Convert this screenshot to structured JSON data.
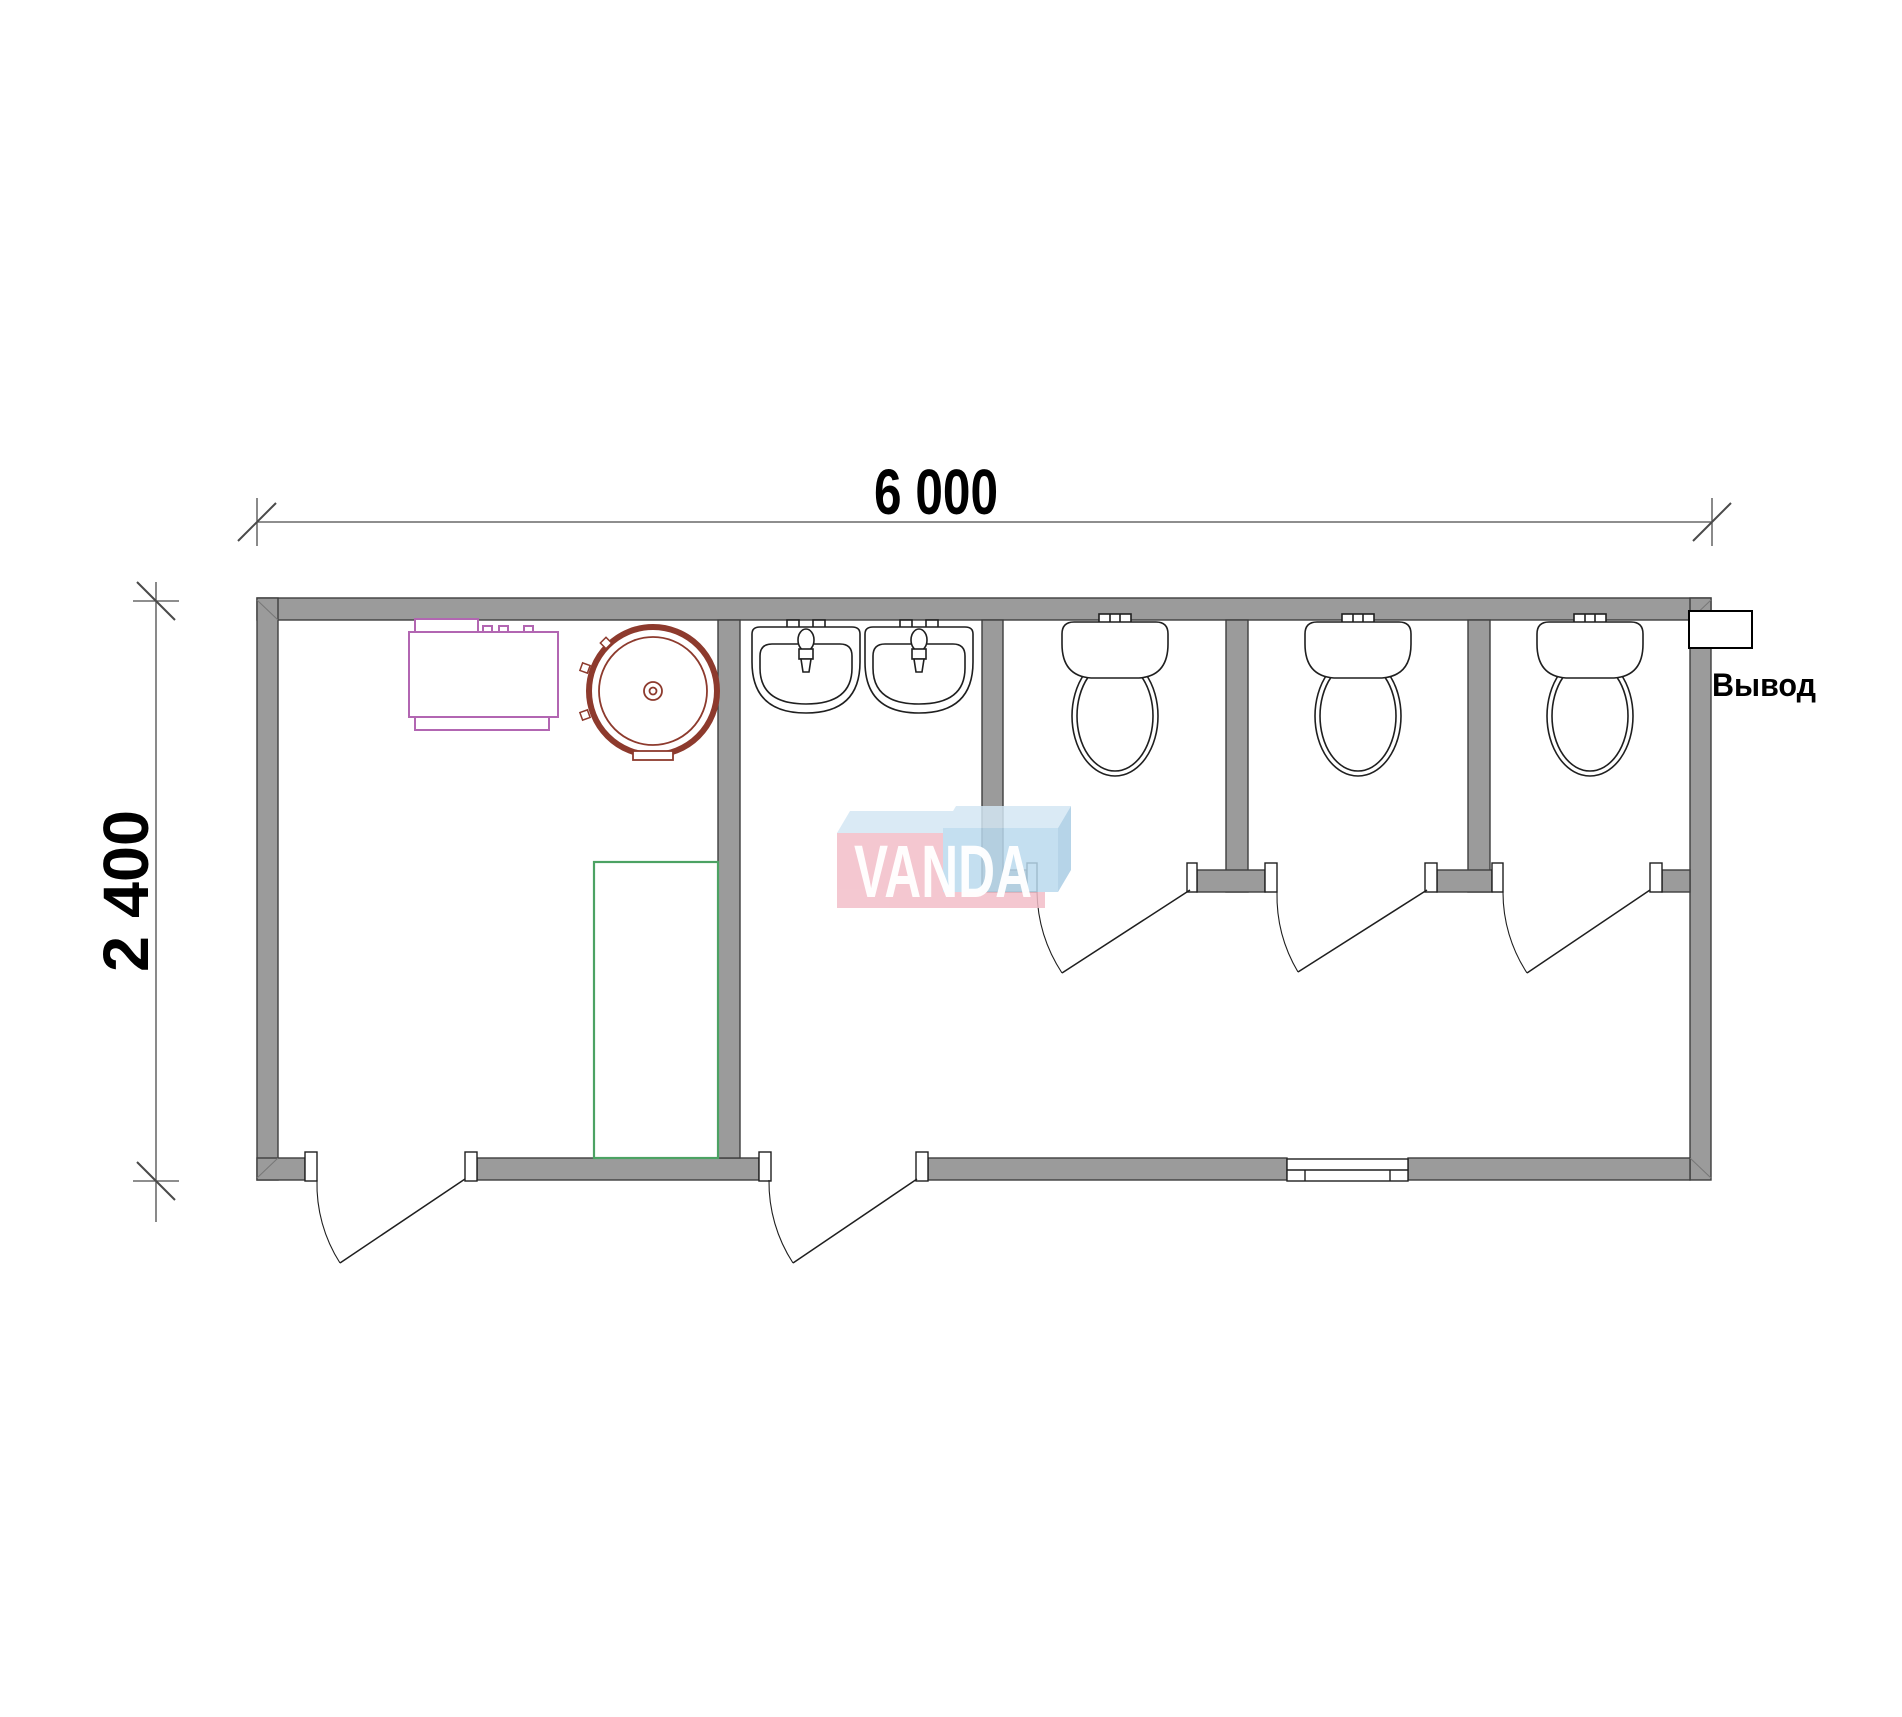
{
  "plan": {
    "dim_width_label": "6 000",
    "dim_height_label": "2 400",
    "width_mm": 6000,
    "height_mm": 2400,
    "outlet_label": "Вывод",
    "watermark_label": "VANDA",
    "fixtures": {
      "toilet_count": 3,
      "sink_count": 2,
      "water_heater_count": 1,
      "shower_tray_count": 1,
      "exterior_door_count": 2,
      "stall_door_count": 3,
      "window_count": 1
    },
    "colors": {
      "wall_fill": "#9B9B9B",
      "wall_edge": "#3F3F3F",
      "line": "#1F1F1F",
      "dim_line": "#4A4A4A",
      "heater_red": "#8D3A2D",
      "cabinet_purple": "#B266B2",
      "shower_green": "#4CA263",
      "watermark_pink": "#F2BDC8",
      "watermark_blue": "#B9D9EE",
      "watermark_top": "#D3E7F4",
      "watermark_side": "#A9CCE4"
    }
  }
}
